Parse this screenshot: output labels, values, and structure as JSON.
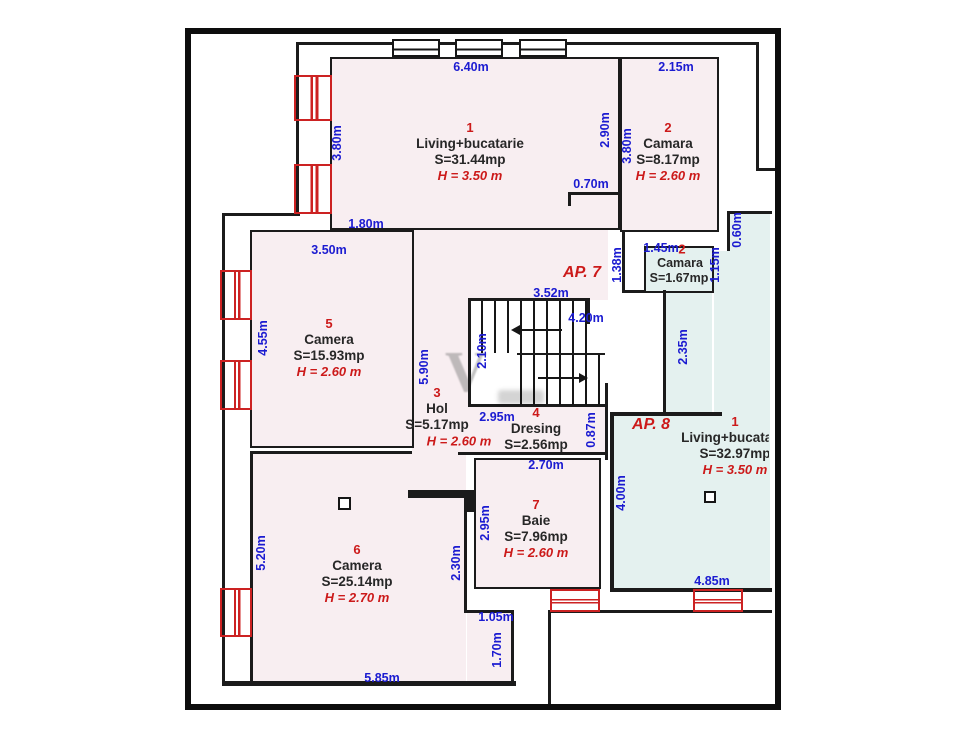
{
  "apartments": {
    "ap7": "AP. 7",
    "ap8": "AP. 8"
  },
  "rooms": [
    {
      "number": "1",
      "name": "Living+bucatarie",
      "area": "S=31.44mp",
      "height": "H = 3.50 m"
    },
    {
      "number": "2",
      "name": "Camara",
      "area": "S=8.17mp",
      "height": "H = 2.60 m"
    },
    {
      "number": "2",
      "name": "Camara",
      "area": "S=1.67mp"
    },
    {
      "number": "5",
      "name": "Camera",
      "area": "S=15.93mp",
      "height": "H = 2.60 m"
    },
    {
      "number": "3",
      "name": "Hol",
      "area": "S=5.17mp",
      "height": "H = 2.60 m"
    },
    {
      "number": "4",
      "name": "Dresing",
      "area": "S=2.56mp"
    },
    {
      "number": "7",
      "name": "Baie",
      "area": "S=7.96mp",
      "height": "H = 2.60 m"
    },
    {
      "number": "6",
      "name": "Camera",
      "area": "S=25.14mp",
      "height": "H = 2.70 m"
    },
    {
      "number": "1",
      "name": "Living+bucatarie",
      "area": "S=32.97mp",
      "height": "H = 3.50 m"
    }
  ],
  "dims": {
    "living_top": "6.40m",
    "living_left": "3.80m",
    "living_offset": "1.80m",
    "living_door": "0.70m",
    "camara_top": "2.15m",
    "camara_out": "2.90m",
    "camara_left": "3.80m",
    "camera5_top": "3.50m",
    "camera5_left": "4.55m",
    "camera5_right": "5.90m",
    "stairs_top": "3.52m",
    "stairs_right": "4.20m",
    "stairs_left": "2.10m",
    "camara_mica_top": "1.45m",
    "camara_mica_left": "1.38m",
    "camara_mica_right": "1.15m",
    "camara_mica_pass": "0.60m",
    "corridor": "2.35m",
    "hol_bottom": "2.95m",
    "dresing_right": "0.87m",
    "baie_top": "2.70m",
    "baie_left": "2.95m",
    "camera6_left": "5.20m",
    "camera6_bottom": "5.85m",
    "camera6_pass": "2.30m",
    "notch_w": "1.05m",
    "notch_h": "1.70m",
    "ap8_left": "4.00m",
    "ap8_bottom": "4.85m"
  },
  "watermark": "V",
  "colors": {
    "dim_blue": "#1b1bd1",
    "accent_red": "#cc1a1a",
    "room_pink": "#f8eef1",
    "room_cyan": "#e4f1ef",
    "wall": "#1b1b1b"
  }
}
